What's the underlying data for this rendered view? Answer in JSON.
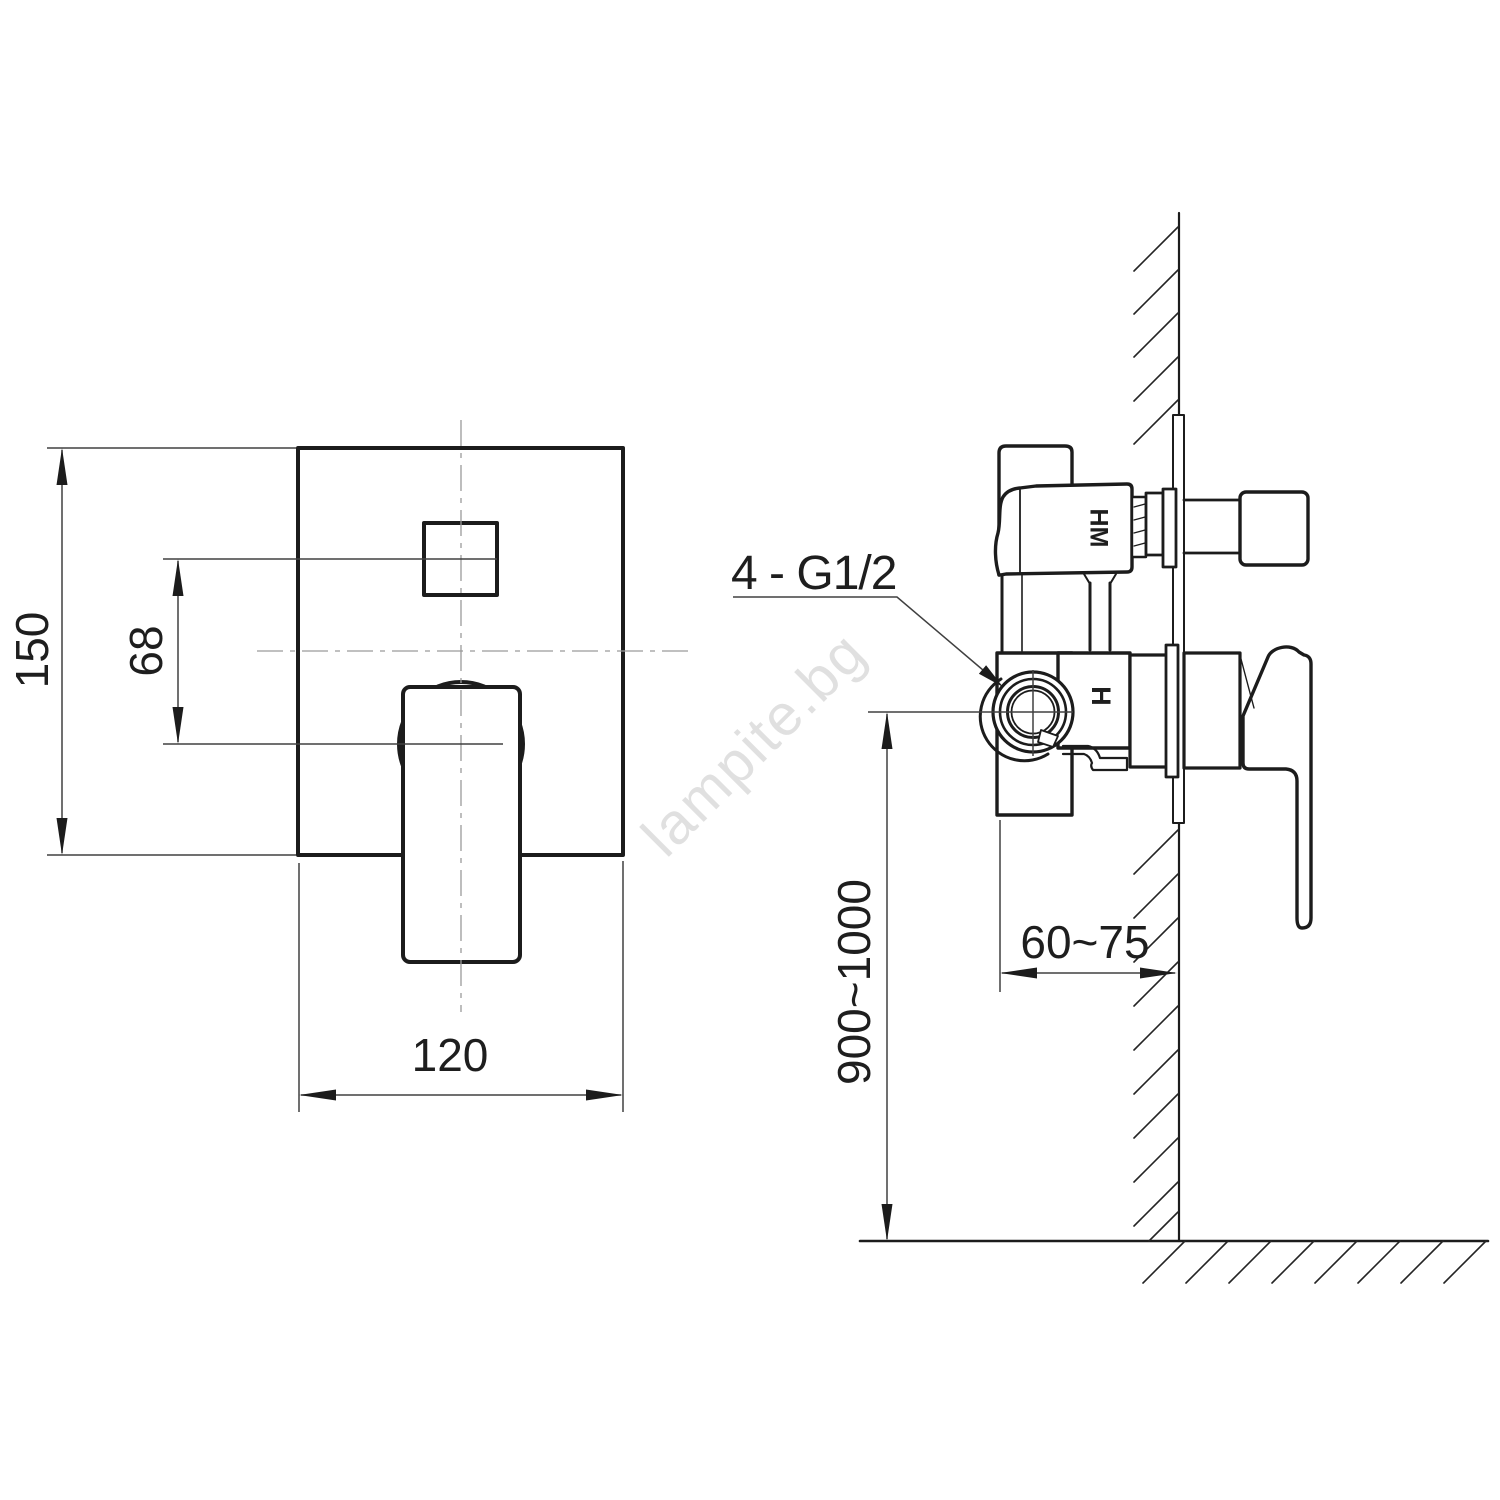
{
  "drawing": {
    "watermark": "lampite.bg",
    "front_view": {
      "height_dim": "150",
      "handle_offset_dim": "68",
      "width_dim": "120"
    },
    "side_view": {
      "connection_label": "4 - G1/2",
      "depth_dim": "60~75",
      "install_height_dim": "900~1000",
      "diverter_mark": "HM",
      "mixer_mark": "H"
    }
  },
  "colors": {
    "ink": "#1c1c1c",
    "thin_line": "#404040",
    "centerline": "#9a9a9a",
    "watermark_gray": "rgba(60,60,60,0.16)",
    "background": "#ffffff"
  }
}
